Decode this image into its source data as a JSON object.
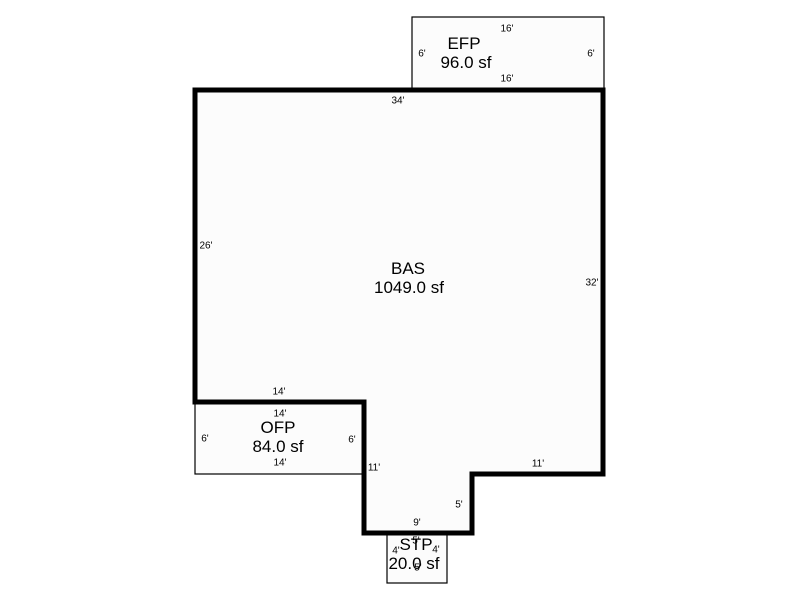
{
  "sketch": {
    "background": "#ffffff",
    "stroke_color": "#000000",
    "fill_color": "#fcfcfc",
    "canvas": {
      "width": 800,
      "height": 600
    },
    "shapes": [
      {
        "name": "efp-porch-outline",
        "type": "rect",
        "x": 412,
        "y": 17,
        "width": 192,
        "height": 73,
        "stroke_width": 1.2
      },
      {
        "name": "ofp-porch-outline",
        "type": "rect",
        "x": 195,
        "y": 402,
        "width": 168,
        "height": 72,
        "stroke_width": 1.2
      },
      {
        "name": "stp-stoop-outline",
        "type": "rect",
        "x": 387,
        "y": 533,
        "width": 60,
        "height": 50,
        "stroke_width": 1.2
      },
      {
        "name": "bas-main-outline",
        "type": "polygon",
        "points": "195,90 603,90 603,474 472,474 472,533 364,533 364,402 195,402",
        "stroke_width": 5
      }
    ],
    "area_labels": [
      {
        "name": "efp-code-label",
        "text": "EFP",
        "x": 464,
        "y": 43
      },
      {
        "name": "efp-area-label",
        "text": "96.0 sf",
        "x": 466,
        "y": 62
      },
      {
        "name": "bas-code-label",
        "text": "BAS",
        "x": 408,
        "y": 268
      },
      {
        "name": "bas-area-label",
        "text": "1049.0 sf",
        "x": 409,
        "y": 287
      },
      {
        "name": "ofp-code-label",
        "text": "OFP",
        "x": 278,
        "y": 427
      },
      {
        "name": "ofp-area-label",
        "text": "84.0 sf",
        "x": 278,
        "y": 446
      },
      {
        "name": "stp-code-label",
        "text": "STP",
        "x": 416,
        "y": 544
      },
      {
        "name": "stp-area-label",
        "text": "20.0 sf",
        "x": 414,
        "y": 563
      }
    ],
    "dimension_labels": [
      {
        "name": "dim-efp-top",
        "text": "16'",
        "x": 507,
        "y": 28
      },
      {
        "name": "dim-efp-left",
        "text": "6'",
        "x": 422,
        "y": 53
      },
      {
        "name": "dim-efp-right",
        "text": "6'",
        "x": 591,
        "y": 53
      },
      {
        "name": "dim-efp-bottom",
        "text": "16'",
        "x": 507,
        "y": 78
      },
      {
        "name": "dim-bas-top",
        "text": "34'",
        "x": 398,
        "y": 100
      },
      {
        "name": "dim-bas-left",
        "text": "26'",
        "x": 206,
        "y": 245
      },
      {
        "name": "dim-bas-right",
        "text": "32'",
        "x": 592,
        "y": 282
      },
      {
        "name": "dim-bas-bottom-left",
        "text": "14'",
        "x": 279,
        "y": 391
      },
      {
        "name": "dim-ofp-top",
        "text": "14'",
        "x": 280,
        "y": 413
      },
      {
        "name": "dim-ofp-left",
        "text": "6'",
        "x": 205,
        "y": 438
      },
      {
        "name": "dim-ofp-right",
        "text": "6'",
        "x": 352,
        "y": 439
      },
      {
        "name": "dim-ofp-bottom",
        "text": "14'",
        "x": 280,
        "y": 462
      },
      {
        "name": "dim-bas-notch-left",
        "text": "11'",
        "x": 374,
        "y": 467
      },
      {
        "name": "dim-bas-step-right",
        "text": "11'",
        "x": 538,
        "y": 463
      },
      {
        "name": "dim-bas-step-down",
        "text": "5'",
        "x": 459,
        "y": 504
      },
      {
        "name": "dim-bas-bottom",
        "text": "9'",
        "x": 417,
        "y": 522
      },
      {
        "name": "dim-stp-top",
        "text": "5'",
        "x": 416,
        "y": 540
      },
      {
        "name": "dim-stp-left",
        "text": "4'",
        "x": 396,
        "y": 550
      },
      {
        "name": "dim-stp-right",
        "text": "4'",
        "x": 436,
        "y": 549
      },
      {
        "name": "dim-stp-bottom",
        "text": "5'",
        "x": 418,
        "y": 567
      }
    ]
  }
}
